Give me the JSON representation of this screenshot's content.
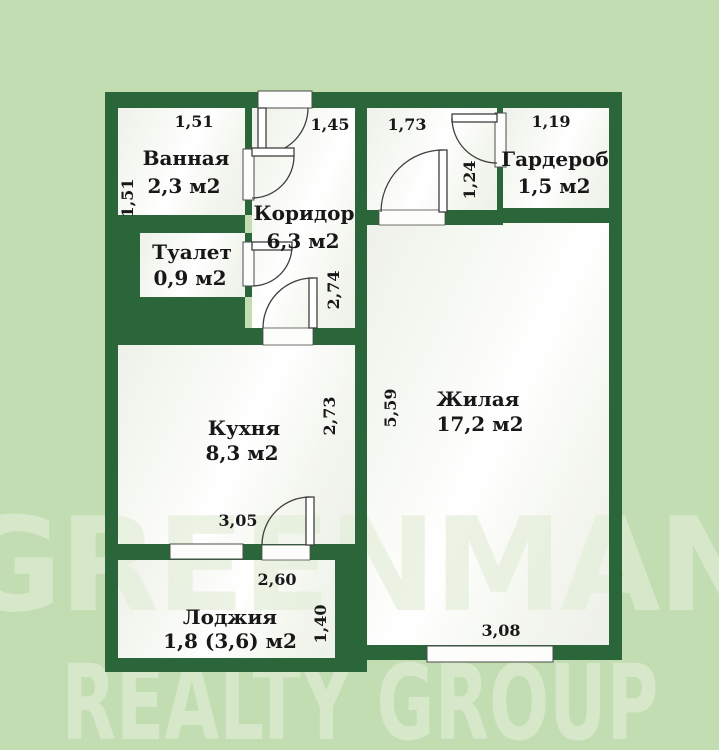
{
  "plan": {
    "rooms": {
      "bathroom": {
        "name": "Ванная",
        "area": "2,3 м2"
      },
      "toilet": {
        "name": "Туалет",
        "area": "0,9 м2"
      },
      "corridor": {
        "name": "Коридор",
        "area": "6,3 м2"
      },
      "wardrobe": {
        "name": "Гардероб",
        "area": "1,5 м2"
      },
      "living": {
        "name": "Жилая",
        "area": "17,2 м2"
      },
      "kitchen": {
        "name": "Кухня",
        "area": "8,3 м2"
      },
      "loggia": {
        "name": "Лоджия",
        "area": "1,8 (3,6) м2"
      }
    },
    "dimensions": {
      "bath_top": "1,51",
      "bath_left": "1,51",
      "corridor_door": "1,45",
      "corridor_height": "2,74",
      "hall_top": "1,73",
      "hall_right": "1,24",
      "wardrobe_top": "1,19",
      "living_left": "5,59",
      "living_bottom": "3,08",
      "kitchen_right": "2,73",
      "kitchen_bottom": "3,05",
      "loggia_top": "2,60",
      "loggia_right": "1,40"
    },
    "colors": {
      "background": "#c2ddb1",
      "wall": "#2b663a",
      "room": "#fbfcf9",
      "label": "#181818"
    }
  },
  "watermark": {
    "line1": "GREENMAN",
    "line2": "REALTY GROUP"
  }
}
